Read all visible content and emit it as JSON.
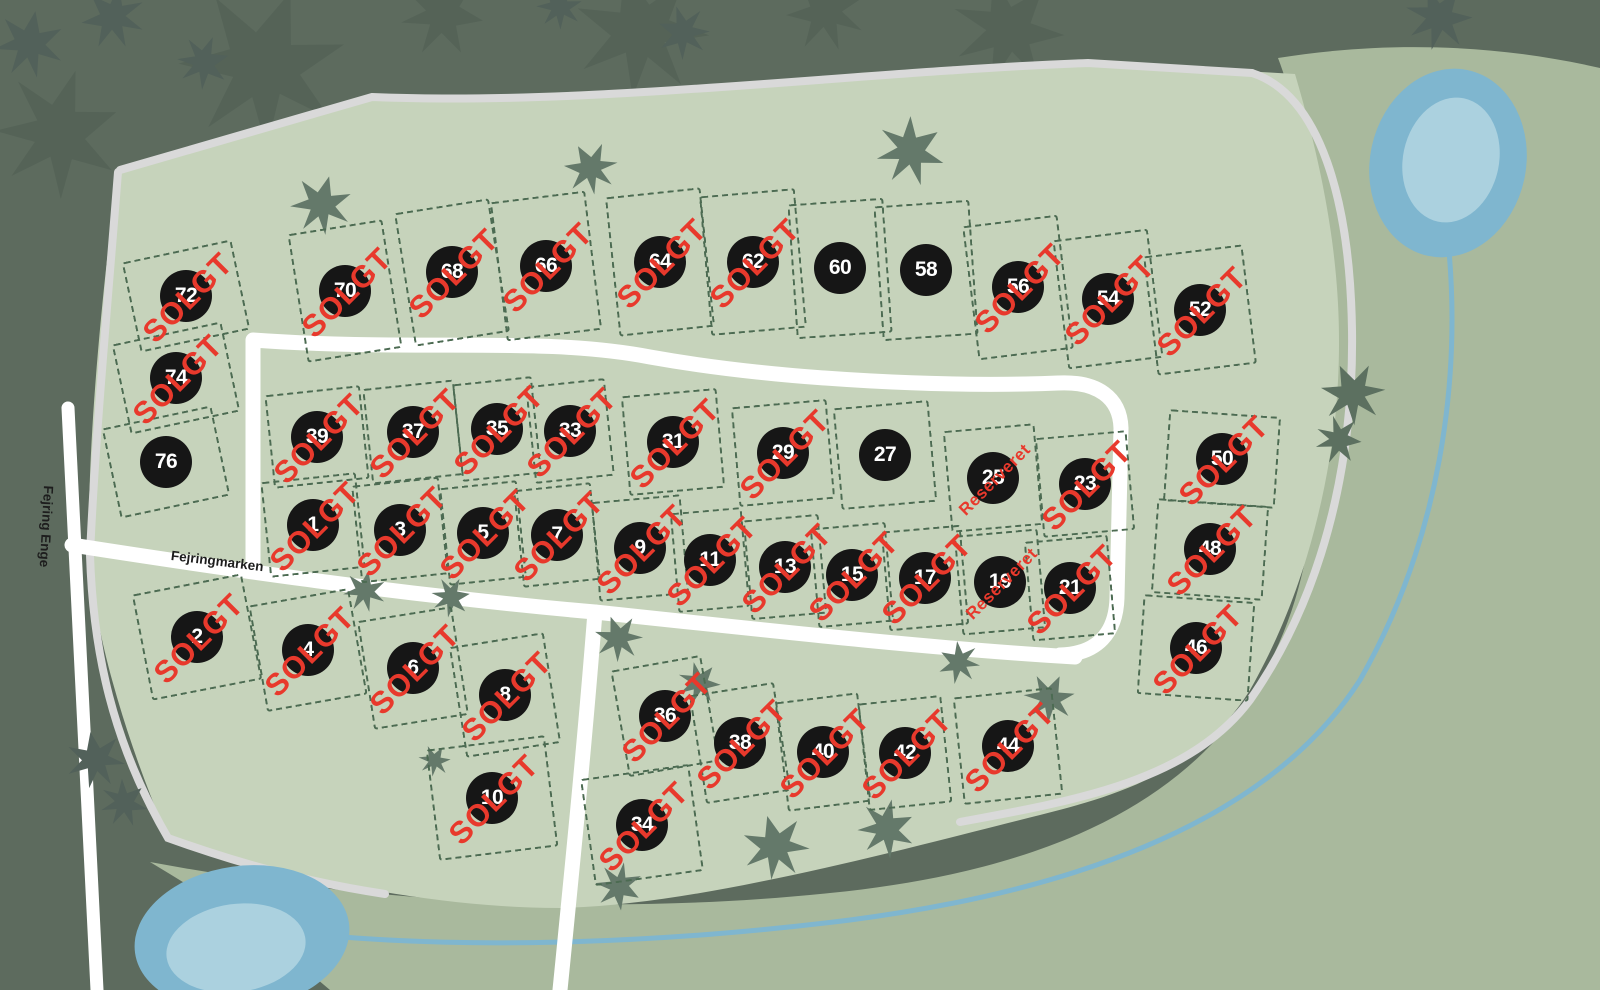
{
  "map": {
    "road_labels": {
      "vertical_road": "Fejring Enge",
      "horizontal_road": "Fejringmarken"
    },
    "status_labels": {
      "sold": "SOLGT",
      "reserved": "Reserveret"
    },
    "colors": {
      "status_red": "#e8392c",
      "plot_circle": "#161616",
      "plot_number_text": "#ffffff",
      "plot_boundary_dash": "#4c6b52",
      "site_light_green": "#c6d3bb",
      "meadow_medium_green": "#a9b99d",
      "background_dark_green": "#5d6b5e",
      "road_white": "#ffffff",
      "path_gray": "#d9d9d9",
      "water_blue": "#7fb6cf",
      "water_light_blue": "#abd1df"
    },
    "plots": [
      {
        "n": "72",
        "s": "sold",
        "x": 186,
        "y": 296,
        "w": 112,
        "h": 92,
        "r": -12
      },
      {
        "n": "74",
        "s": "sold",
        "x": 176,
        "y": 378,
        "w": 112,
        "h": 92,
        "r": -12
      },
      {
        "n": "76",
        "s": "free",
        "x": 166,
        "y": 462,
        "w": 112,
        "h": 92,
        "r": -12
      },
      {
        "n": "70",
        "s": "sold",
        "x": 345,
        "y": 291,
        "w": 96,
        "h": 130,
        "r": -9
      },
      {
        "n": "68",
        "s": "sold",
        "x": 452,
        "y": 272,
        "w": 96,
        "h": 135,
        "r": -9
      },
      {
        "n": "66",
        "s": "sold",
        "x": 546,
        "y": 266,
        "w": 96,
        "h": 140,
        "r": -7
      },
      {
        "n": "64",
        "s": "sold",
        "x": 660,
        "y": 262,
        "w": 96,
        "h": 140,
        "r": -6
      },
      {
        "n": "62",
        "s": "sold",
        "x": 753,
        "y": 262,
        "w": 96,
        "h": 140,
        "r": -5
      },
      {
        "n": "60",
        "s": "free",
        "x": 840,
        "y": 268,
        "w": 96,
        "h": 135,
        "r": -4
      },
      {
        "n": "58",
        "s": "free",
        "x": 926,
        "y": 270,
        "w": 96,
        "h": 135,
        "r": -4
      },
      {
        "n": "56",
        "s": "sold",
        "x": 1018,
        "y": 287,
        "w": 96,
        "h": 135,
        "r": -7
      },
      {
        "n": "54",
        "s": "sold",
        "x": 1108,
        "y": 299,
        "w": 96,
        "h": 130,
        "r": -7
      },
      {
        "n": "52",
        "s": "sold",
        "x": 1200,
        "y": 310,
        "w": 100,
        "h": 120,
        "r": -7
      },
      {
        "n": "50",
        "s": "sold",
        "x": 1222,
        "y": 459,
        "w": 112,
        "h": 92,
        "r": 4
      },
      {
        "n": "48",
        "s": "sold",
        "x": 1210,
        "y": 549,
        "w": 112,
        "h": 95,
        "r": 4
      },
      {
        "n": "46",
        "s": "sold",
        "x": 1196,
        "y": 648,
        "w": 112,
        "h": 100,
        "r": 4
      },
      {
        "n": "39",
        "s": "sold",
        "x": 317,
        "y": 437,
        "w": 96,
        "h": 94,
        "r": -6
      },
      {
        "n": "37",
        "s": "sold",
        "x": 413,
        "y": 432,
        "w": 92,
        "h": 96,
        "r": -6
      },
      {
        "n": "35",
        "s": "sold",
        "x": 497,
        "y": 429,
        "w": 80,
        "h": 98,
        "r": -6
      },
      {
        "n": "33",
        "s": "sold",
        "x": 570,
        "y": 431,
        "w": 80,
        "h": 98,
        "r": -6
      },
      {
        "n": "31",
        "s": "sold",
        "x": 673,
        "y": 442,
        "w": 96,
        "h": 100,
        "r": -5
      },
      {
        "n": "29",
        "s": "sold",
        "x": 783,
        "y": 453,
        "w": 96,
        "h": 100,
        "r": -5
      },
      {
        "n": "27",
        "s": "free",
        "x": 885,
        "y": 455,
        "w": 96,
        "h": 102,
        "r": -5
      },
      {
        "n": "25",
        "s": "reserved",
        "x": 993,
        "y": 478,
        "w": 92,
        "h": 102,
        "r": -5
      },
      {
        "n": "23",
        "s": "sold",
        "x": 1085,
        "y": 484,
        "w": 92,
        "h": 100,
        "r": -5
      },
      {
        "n": "1",
        "s": "sold",
        "x": 313,
        "y": 525,
        "w": 96,
        "h": 96,
        "r": -6
      },
      {
        "n": "3",
        "s": "sold",
        "x": 400,
        "y": 530,
        "w": 88,
        "h": 98,
        "r": -6
      },
      {
        "n": "5",
        "s": "sold",
        "x": 483,
        "y": 533,
        "w": 78,
        "h": 98,
        "r": -6
      },
      {
        "n": "7",
        "s": "sold",
        "x": 557,
        "y": 535,
        "w": 78,
        "h": 98,
        "r": -6
      },
      {
        "n": "9",
        "s": "sold",
        "x": 640,
        "y": 548,
        "w": 90,
        "h": 100,
        "r": -5
      },
      {
        "n": "11",
        "s": "sold",
        "x": 710,
        "y": 560,
        "w": 72,
        "h": 100,
        "r": -5
      },
      {
        "n": "13",
        "s": "sold",
        "x": 785,
        "y": 567,
        "w": 76,
        "h": 100,
        "r": -5
      },
      {
        "n": "15",
        "s": "sold",
        "x": 852,
        "y": 575,
        "w": 76,
        "h": 100,
        "r": -5
      },
      {
        "n": "17",
        "s": "sold",
        "x": 925,
        "y": 578,
        "w": 80,
        "h": 100,
        "r": -5
      },
      {
        "n": "19",
        "s": "reserved",
        "x": 1000,
        "y": 582,
        "w": 84,
        "h": 100,
        "r": -5
      },
      {
        "n": "21",
        "s": "sold",
        "x": 1070,
        "y": 588,
        "w": 84,
        "h": 100,
        "r": -5
      },
      {
        "n": "2",
        "s": "sold",
        "x": 197,
        "y": 637,
        "w": 112,
        "h": 108,
        "r": -11
      },
      {
        "n": "4",
        "s": "sold",
        "x": 308,
        "y": 650,
        "w": 102,
        "h": 108,
        "r": -10
      },
      {
        "n": "6",
        "s": "sold",
        "x": 413,
        "y": 668,
        "w": 96,
        "h": 110,
        "r": -9
      },
      {
        "n": "8",
        "s": "sold",
        "x": 505,
        "y": 695,
        "w": 96,
        "h": 112,
        "r": -9
      },
      {
        "n": "10",
        "s": "sold",
        "x": 492,
        "y": 798,
        "w": 120,
        "h": 112,
        "r": -7
      },
      {
        "n": "36",
        "s": "sold",
        "x": 665,
        "y": 716,
        "w": 92,
        "h": 108,
        "r": -10
      },
      {
        "n": "38",
        "s": "sold",
        "x": 740,
        "y": 743,
        "w": 86,
        "h": 110,
        "r": -9
      },
      {
        "n": "40",
        "s": "sold",
        "x": 823,
        "y": 752,
        "w": 84,
        "h": 110,
        "r": -7
      },
      {
        "n": "42",
        "s": "sold",
        "x": 905,
        "y": 753,
        "w": 84,
        "h": 108,
        "r": -6
      },
      {
        "n": "44",
        "s": "sold",
        "x": 1008,
        "y": 746,
        "w": 100,
        "h": 108,
        "r": -6
      },
      {
        "n": "34",
        "s": "sold",
        "x": 642,
        "y": 825,
        "w": 110,
        "h": 108,
        "r": -8
      }
    ]
  }
}
